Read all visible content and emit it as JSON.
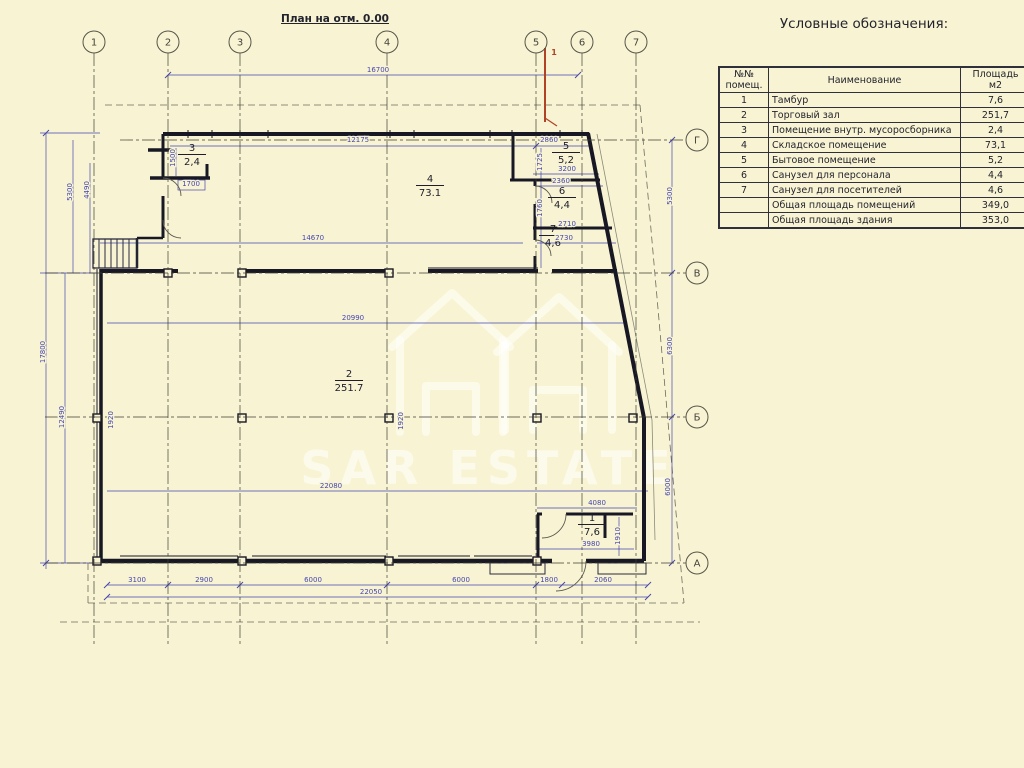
{
  "title": "План на отм. 0.00",
  "legend": {
    "title": "Условные обозначения:",
    "table": {
      "headers": [
        "№№\nпомещ.",
        "Наименование",
        "Площадь\nм2"
      ],
      "rows": [
        [
          "1",
          "Тамбур",
          "7,6"
        ],
        [
          "2",
          "Торговый зал",
          "251,7"
        ],
        [
          "3",
          "Помещение внутр. мусоросборника",
          "2,4"
        ],
        [
          "4",
          "Складское помещение",
          "73,1"
        ],
        [
          "5",
          "Бытовое помещение",
          "5,2"
        ],
        [
          "6",
          "Санузел для персонала",
          "4,4"
        ],
        [
          "7",
          "Санузел для посетителей",
          "4,6"
        ],
        [
          "",
          "Общая площадь помещений",
          "349,0"
        ],
        [
          "",
          "Общая площадь здания",
          "353,0"
        ]
      ]
    }
  },
  "watermark": {
    "text": "SAR ESTATE"
  },
  "markers": {
    "red_callout": "1"
  },
  "colors": {
    "background": "#f8f4d3",
    "wall": "#181824",
    "dimension_blue": "#4545b0",
    "grid_line": "#3d3d33",
    "red_marker": "#b04326",
    "table_ink": "#23232e",
    "watermark_white": "#ffffff"
  },
  "grid_axes": {
    "columns": [
      {
        "label": "1",
        "x": 94
      },
      {
        "label": "2",
        "x": 168
      },
      {
        "label": "3",
        "x": 240
      },
      {
        "label": "4",
        "x": 387
      },
      {
        "label": "5",
        "x": 536
      },
      {
        "label": "6",
        "x": 582
      },
      {
        "label": "7",
        "x": 636
      }
    ],
    "rows": [
      {
        "label": "Г",
        "y": 140
      },
      {
        "label": "В",
        "y": 273
      },
      {
        "label": "Б",
        "y": 417
      },
      {
        "label": "А",
        "y": 563
      }
    ]
  },
  "rooms": [
    {
      "number": "1",
      "area": "7,6",
      "x": 592,
      "y": 521
    },
    {
      "number": "2",
      "area": "251.7",
      "x": 349,
      "y": 377
    },
    {
      "number": "3",
      "area": "2,4",
      "x": 192,
      "y": 151
    },
    {
      "number": "4",
      "area": "73.1",
      "x": 430,
      "y": 182
    },
    {
      "number": "5",
      "area": "5,2",
      "x": 566,
      "y": 149
    },
    {
      "number": "6",
      "area": "4,4",
      "x": 562,
      "y": 194
    },
    {
      "number": "7",
      "area": "4,6",
      "x": 553,
      "y": 232
    }
  ],
  "dimensions": [
    {
      "text": "16700",
      "x": 378,
      "y": 72
    },
    {
      "text": "12175",
      "x": 358,
      "y": 142
    },
    {
      "text": "2860",
      "x": 549,
      "y": 142
    },
    {
      "text": "3200",
      "x": 567,
      "y": 171
    },
    {
      "text": "2360",
      "x": 561,
      "y": 183
    },
    {
      "text": "2710",
      "x": 567,
      "y": 226
    },
    {
      "text": "2730",
      "x": 564,
      "y": 240
    },
    {
      "text": "1700",
      "x": 191,
      "y": 186
    },
    {
      "text": "14670",
      "x": 313,
      "y": 240
    },
    {
      "text": "20990",
      "x": 353,
      "y": 320
    },
    {
      "text": "22080",
      "x": 331,
      "y": 488
    },
    {
      "text": "4080",
      "x": 597,
      "y": 505
    },
    {
      "text": "3980",
      "x": 591,
      "y": 546
    },
    {
      "text": "1910",
      "x": 620,
      "y": 536,
      "r": -90
    },
    {
      "text": "3100",
      "x": 137,
      "y": 582
    },
    {
      "text": "2900",
      "x": 204,
      "y": 582
    },
    {
      "text": "6000",
      "x": 313,
      "y": 582
    },
    {
      "text": "6000",
      "x": 461,
      "y": 582
    },
    {
      "text": "1800",
      "x": 549,
      "y": 582
    },
    {
      "text": "2060",
      "x": 603,
      "y": 582
    },
    {
      "text": "22050",
      "x": 371,
      "y": 594
    },
    {
      "text": "5300",
      "x": 72,
      "y": 192,
      "r": -90
    },
    {
      "text": "4490",
      "x": 89,
      "y": 190,
      "r": -90
    },
    {
      "text": "17800",
      "x": 45,
      "y": 352,
      "r": -90
    },
    {
      "text": "12490",
      "x": 64,
      "y": 417,
      "r": -90
    },
    {
      "text": "1920",
      "x": 113,
      "y": 420,
      "r": -90
    },
    {
      "text": "1920",
      "x": 403,
      "y": 421,
      "r": -90
    },
    {
      "text": "5300",
      "x": 672,
      "y": 196,
      "r": -90
    },
    {
      "text": "6300",
      "x": 672,
      "y": 346,
      "r": -90
    },
    {
      "text": "6000",
      "x": 670,
      "y": 487,
      "r": -90
    },
    {
      "text": "1725",
      "x": 542,
      "y": 162,
      "r": -90
    },
    {
      "text": "1760",
      "x": 542,
      "y": 208,
      "r": -90
    },
    {
      "text": "1500",
      "x": 175,
      "y": 158,
      "r": -90
    }
  ]
}
